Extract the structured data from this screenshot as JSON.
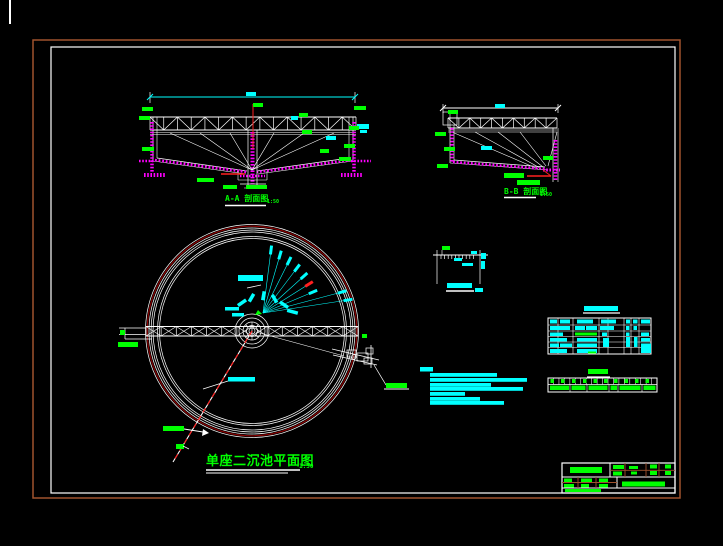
{
  "app": {
    "type": "cad-drawing-viewer",
    "background": "#000000"
  },
  "frame": {
    "outer_border_color": "#A0522D",
    "inner_border_color": "#FFFFFF"
  },
  "colors": {
    "white": "#FFFFFF",
    "cyan": "#00FFFF",
    "green": "#00FF00",
    "magenta": "#FF00FF",
    "red": "#FF2020",
    "dark_red_ring": "#8B0000",
    "brown": "#A0522D"
  },
  "titles": {
    "plan": "单座二沉池平面图",
    "plan_scale": "1:50",
    "section_a": "A-A 剖面图",
    "section_a_scale": "1:50",
    "section_b": "B-B 剖面图",
    "section_b_scale": "1:50"
  }
}
